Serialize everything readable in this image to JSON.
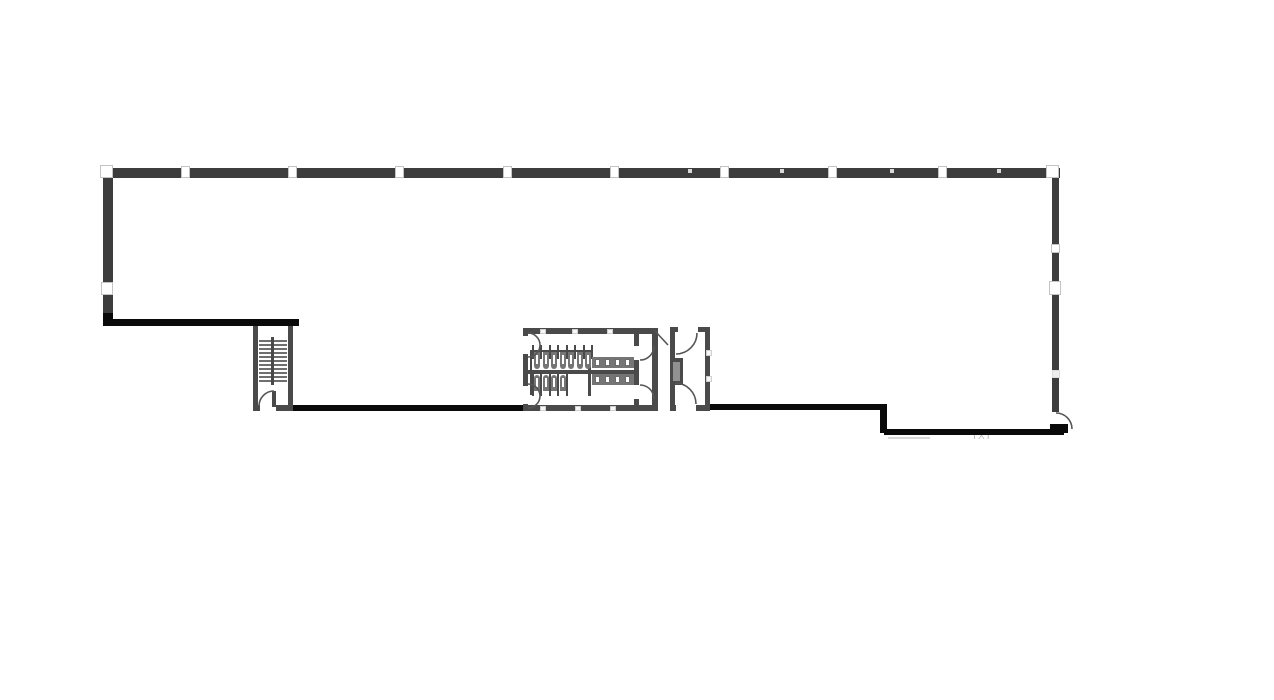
{
  "title": "building-floor-plan",
  "annotation": {
    "text": "IXI"
  },
  "colors": {
    "dark": "#3d3d3d",
    "black": "#0a0a0a",
    "gray": "#4a4a4a",
    "mid": "#919191",
    "fixture": "#757575",
    "tread": "#6f6f6f",
    "arc_stroke": "#565656",
    "background": "#ffffff",
    "faint": "#d8d8d8",
    "label": "#bdbdbd"
  },
  "canvas": {
    "w": 1274,
    "h": 700
  },
  "walls": [
    {
      "name": "top-exterior-wall",
      "x": 103,
      "y": 168,
      "w": 957,
      "h": 10,
      "c": "dark"
    },
    {
      "name": "left-exterior-wall",
      "x": 103,
      "y": 178,
      "w": 10,
      "h": 140,
      "c": "dark"
    },
    {
      "name": "left-wall-black-corner",
      "x": 103,
      "y": 313,
      "w": 10,
      "h": 13,
      "c": "black"
    },
    {
      "name": "right-exterior-wall",
      "x": 1052,
      "y": 178,
      "w": 7,
      "h": 234,
      "c": "dark"
    },
    {
      "name": "lower-left-interior-wall",
      "x": 103,
      "y": 319,
      "w": 196,
      "h": 7,
      "c": "black"
    },
    {
      "name": "stair-left-wall",
      "x": 253,
      "y": 326,
      "w": 5,
      "h": 85,
      "c": "gray"
    },
    {
      "name": "stair-right-wall",
      "x": 288,
      "y": 326,
      "w": 5,
      "h": 85,
      "c": "gray"
    },
    {
      "name": "stair-bottom-left-stub",
      "x": 253,
      "y": 405,
      "w": 7,
      "h": 6,
      "c": "gray"
    },
    {
      "name": "stair-bottom-right-wall",
      "x": 276,
      "y": 405,
      "w": 17,
      "h": 6,
      "c": "gray"
    },
    {
      "name": "stair-door-leaf",
      "x": 272,
      "y": 391,
      "w": 4,
      "h": 16,
      "c": "gray"
    },
    {
      "name": "stair-divider",
      "x": 271,
      "y": 337,
      "w": 3,
      "h": 48,
      "c": "gray"
    },
    {
      "name": "corridor-wall-black-left",
      "x": 293,
      "y": 405,
      "w": 237,
      "h": 6,
      "c": "black"
    },
    {
      "name": "restroom-top-wall",
      "x": 523,
      "y": 328,
      "w": 135,
      "h": 6,
      "c": "gray"
    },
    {
      "name": "restroom-bottom-wall",
      "x": 523,
      "y": 405,
      "w": 135,
      "h": 6,
      "c": "gray"
    },
    {
      "name": "restroom-left-wall-upper",
      "x": 523,
      "y": 328,
      "w": 5,
      "h": 8,
      "c": "gray"
    },
    {
      "name": "restroom-left-wall-middle",
      "x": 523,
      "y": 354,
      "w": 5,
      "h": 32,
      "c": "gray"
    },
    {
      "name": "restroom-left-wall-lower",
      "x": 523,
      "y": 404,
      "w": 5,
      "h": 7,
      "c": "gray"
    },
    {
      "name": "restroom-center-wall",
      "x": 528,
      "y": 370,
      "w": 108,
      "h": 4,
      "c": "gray"
    },
    {
      "name": "stall-rail-left",
      "x": 530,
      "y": 350,
      "w": 2,
      "h": 45,
      "c": "gray"
    },
    {
      "name": "stall-rail-top",
      "x": 530,
      "y": 350,
      "w": 62,
      "h": 2,
      "c": "gray"
    },
    {
      "name": "stall-counter-divider",
      "x": 588,
      "y": 352,
      "w": 3,
      "h": 44,
      "c": "gray"
    },
    {
      "name": "vestibule-wall-upper",
      "x": 634,
      "y": 330,
      "w": 5,
      "h": 16,
      "c": "gray"
    },
    {
      "name": "vestibule-wall-middle",
      "x": 634,
      "y": 360,
      "w": 5,
      "h": 25,
      "c": "gray"
    },
    {
      "name": "vestibule-wall-lower",
      "x": 634,
      "y": 399,
      "w": 5,
      "h": 12,
      "c": "gray"
    },
    {
      "name": "restroom-right-wall",
      "x": 652,
      "y": 330,
      "w": 6,
      "h": 81,
      "c": "gray"
    },
    {
      "name": "utility-room-left-wall",
      "x": 670,
      "y": 327,
      "w": 5,
      "h": 84,
      "c": "gray"
    },
    {
      "name": "utility-room-right-wall",
      "x": 705,
      "y": 327,
      "w": 5,
      "h": 84,
      "c": "gray"
    },
    {
      "name": "utility-room-top-wall-left",
      "x": 670,
      "y": 327,
      "w": 8,
      "h": 5,
      "c": "gray"
    },
    {
      "name": "utility-room-top-wall-right",
      "x": 698,
      "y": 327,
      "w": 12,
      "h": 5,
      "c": "gray"
    },
    {
      "name": "utility-room-bottom-wall-left",
      "x": 670,
      "y": 405,
      "w": 6,
      "h": 6,
      "c": "gray"
    },
    {
      "name": "utility-room-bottom-wall-right",
      "x": 696,
      "y": 405,
      "w": 14,
      "h": 6,
      "c": "gray"
    },
    {
      "name": "utility-room-closet",
      "x": 670,
      "y": 358,
      "w": 13,
      "h": 27,
      "c": "gray"
    },
    {
      "name": "utility-room-closet-inner",
      "x": 673,
      "y": 362,
      "w": 7,
      "h": 19,
      "c": "mid"
    },
    {
      "name": "corridor-wall-black-right",
      "x": 710,
      "y": 404,
      "w": 173,
      "h": 6,
      "c": "black"
    },
    {
      "name": "right-step-wall",
      "x": 880,
      "y": 404,
      "w": 7,
      "h": 29,
      "c": "black"
    },
    {
      "name": "bottom-right-exterior-wall",
      "x": 884,
      "y": 429,
      "w": 180,
      "h": 6,
      "c": "black"
    },
    {
      "name": "exterior-door-leaf",
      "x": 1050,
      "y": 424,
      "w": 18,
      "h": 9,
      "c": "black"
    }
  ],
  "markers": [
    {
      "x": 100,
      "y": 165,
      "w": 13,
      "h": 13,
      "v": "bright"
    },
    {
      "x": 1046,
      "y": 165,
      "w": 13,
      "h": 13,
      "v": "bright"
    },
    {
      "x": 181,
      "y": 166,
      "w": 9,
      "h": 12,
      "v": "bright"
    },
    {
      "x": 288,
      "y": 166,
      "w": 9,
      "h": 12,
      "v": "bright"
    },
    {
      "x": 395,
      "y": 166,
      "w": 9,
      "h": 12,
      "v": "bright"
    },
    {
      "x": 503,
      "y": 166,
      "w": 9,
      "h": 12,
      "v": "bright"
    },
    {
      "x": 610,
      "y": 166,
      "w": 9,
      "h": 12,
      "v": "bright"
    },
    {
      "x": 720,
      "y": 166,
      "w": 9,
      "h": 12,
      "v": "bright"
    },
    {
      "x": 828,
      "y": 166,
      "w": 9,
      "h": 12,
      "v": "bright"
    },
    {
      "x": 938,
      "y": 166,
      "w": 9,
      "h": 12,
      "v": "bright"
    },
    {
      "x": 688,
      "y": 169,
      "w": 4,
      "h": 4,
      "v": "speck"
    },
    {
      "x": 780,
      "y": 169,
      "w": 4,
      "h": 4,
      "v": "speck"
    },
    {
      "x": 890,
      "y": 169,
      "w": 4,
      "h": 4,
      "v": "speck"
    },
    {
      "x": 997,
      "y": 169,
      "w": 4,
      "h": 4,
      "v": "speck"
    },
    {
      "x": 101,
      "y": 282,
      "w": 12,
      "h": 13,
      "v": "bright"
    },
    {
      "x": 1051,
      "y": 244,
      "w": 9,
      "h": 9,
      "v": "bright"
    },
    {
      "x": 1049,
      "y": 281,
      "w": 12,
      "h": 14,
      "v": "bright"
    },
    {
      "x": 1052,
      "y": 370,
      "w": 8,
      "h": 8,
      "v": "faint"
    },
    {
      "x": 540,
      "y": 329,
      "w": 6,
      "h": 5,
      "v": "small"
    },
    {
      "x": 572,
      "y": 329,
      "w": 6,
      "h": 5,
      "v": "small"
    },
    {
      "x": 607,
      "y": 329,
      "w": 6,
      "h": 5,
      "v": "small"
    },
    {
      "x": 540,
      "y": 406,
      "w": 6,
      "h": 5,
      "v": "small"
    },
    {
      "x": 575,
      "y": 406,
      "w": 6,
      "h": 5,
      "v": "small"
    },
    {
      "x": 610,
      "y": 406,
      "w": 6,
      "h": 5,
      "v": "small"
    },
    {
      "x": 706,
      "y": 350,
      "w": 6,
      "h": 6,
      "v": "small"
    },
    {
      "x": 706,
      "y": 376,
      "w": 6,
      "h": 6,
      "v": "small"
    }
  ],
  "stairs": {
    "tread_columns": [
      {
        "x": 259,
        "w": 12
      },
      {
        "x": 274,
        "w": 13
      }
    ],
    "tread_y0": 340,
    "tread_step": 4,
    "tread_count": 11,
    "tread_h": 2
  },
  "stall_rows": [
    {
      "name": "mens-stalls",
      "x0": 533,
      "pitch": 8.5,
      "count": 7,
      "part_y": 345,
      "part_h": 14,
      "body_y": 352,
      "body_h": 17,
      "body_w": 6,
      "slot_y": 355,
      "slot_h": 9,
      "dir": "down"
    },
    {
      "name": "womens-stalls",
      "x0": 533,
      "pitch": 8.5,
      "count": 4,
      "part_y": 374,
      "part_h": 22,
      "body_y": 375,
      "body_h": 16,
      "body_w": 6,
      "slot_y": 378,
      "slot_h": 9,
      "dir": "up"
    }
  ],
  "counters": [
    {
      "name": "sink-counter-upper",
      "x": 592,
      "y": 357,
      "w": 42,
      "h": 11,
      "dash_y": 359,
      "dashes": 4
    },
    {
      "name": "sink-counter-lower",
      "x": 592,
      "y": 374,
      "w": 42,
      "h": 11,
      "dash_y": 376,
      "dashes": 4
    }
  ],
  "arcs": [
    {
      "name": "stair-door-swing",
      "d": "M 259 406 A 15 15 0 0 1 274 391"
    },
    {
      "name": "restroom-door-swing-top",
      "d": "M 528 333 A 12 12 0 0 1 528 357"
    },
    {
      "name": "restroom-door-swing-bottom",
      "d": "M 528 384 A 12 12 0 0 1 528 408"
    },
    {
      "name": "vestibule-door-swing-top",
      "d": "M 654 346 A 14 14 0 0 1 640 360"
    },
    {
      "name": "vestibule-door-swing-bottom",
      "d": "M 640 385 A 14 14 0 0 1 654 399"
    },
    {
      "name": "corridor-door-leaf",
      "d": "M 655 331 L 668 345"
    },
    {
      "name": "utility-door-swing-top",
      "d": "M 697 333 A 21 21 0 0 1 676 354"
    },
    {
      "name": "utility-door-swing-bottom",
      "d": "M 675 383 A 21 21 0 0 1 696 404"
    },
    {
      "name": "exterior-door-swing",
      "d": "M 1056 413 A 16 16 0 0 1 1072 429"
    }
  ],
  "faint_lines": [
    {
      "name": "faint-shadow-line",
      "x": 888,
      "y": 437,
      "w": 42,
      "h": 2
    }
  ]
}
